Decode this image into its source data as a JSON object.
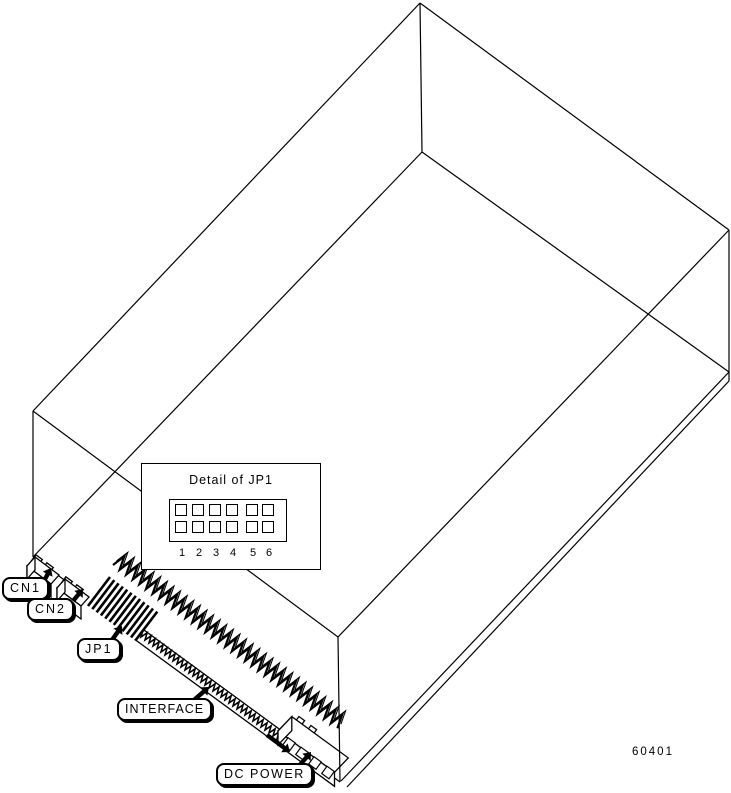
{
  "page": {
    "background": "#ffffff",
    "line_color": "#000000"
  },
  "figure_code": "60401",
  "callouts": {
    "cn1": {
      "label": "CN1"
    },
    "cn2": {
      "label": "CN2"
    },
    "jp1": {
      "label": "JP1"
    },
    "interface": {
      "label": "INTERFACE"
    },
    "dc_power": {
      "label": "DC POWER"
    }
  },
  "detail_inset": {
    "title": "Detail of JP1",
    "pin_rows": 2,
    "pin_columns": 6,
    "pin_numbers": [
      "1",
      "2",
      "3",
      "4",
      "5",
      "6"
    ]
  }
}
